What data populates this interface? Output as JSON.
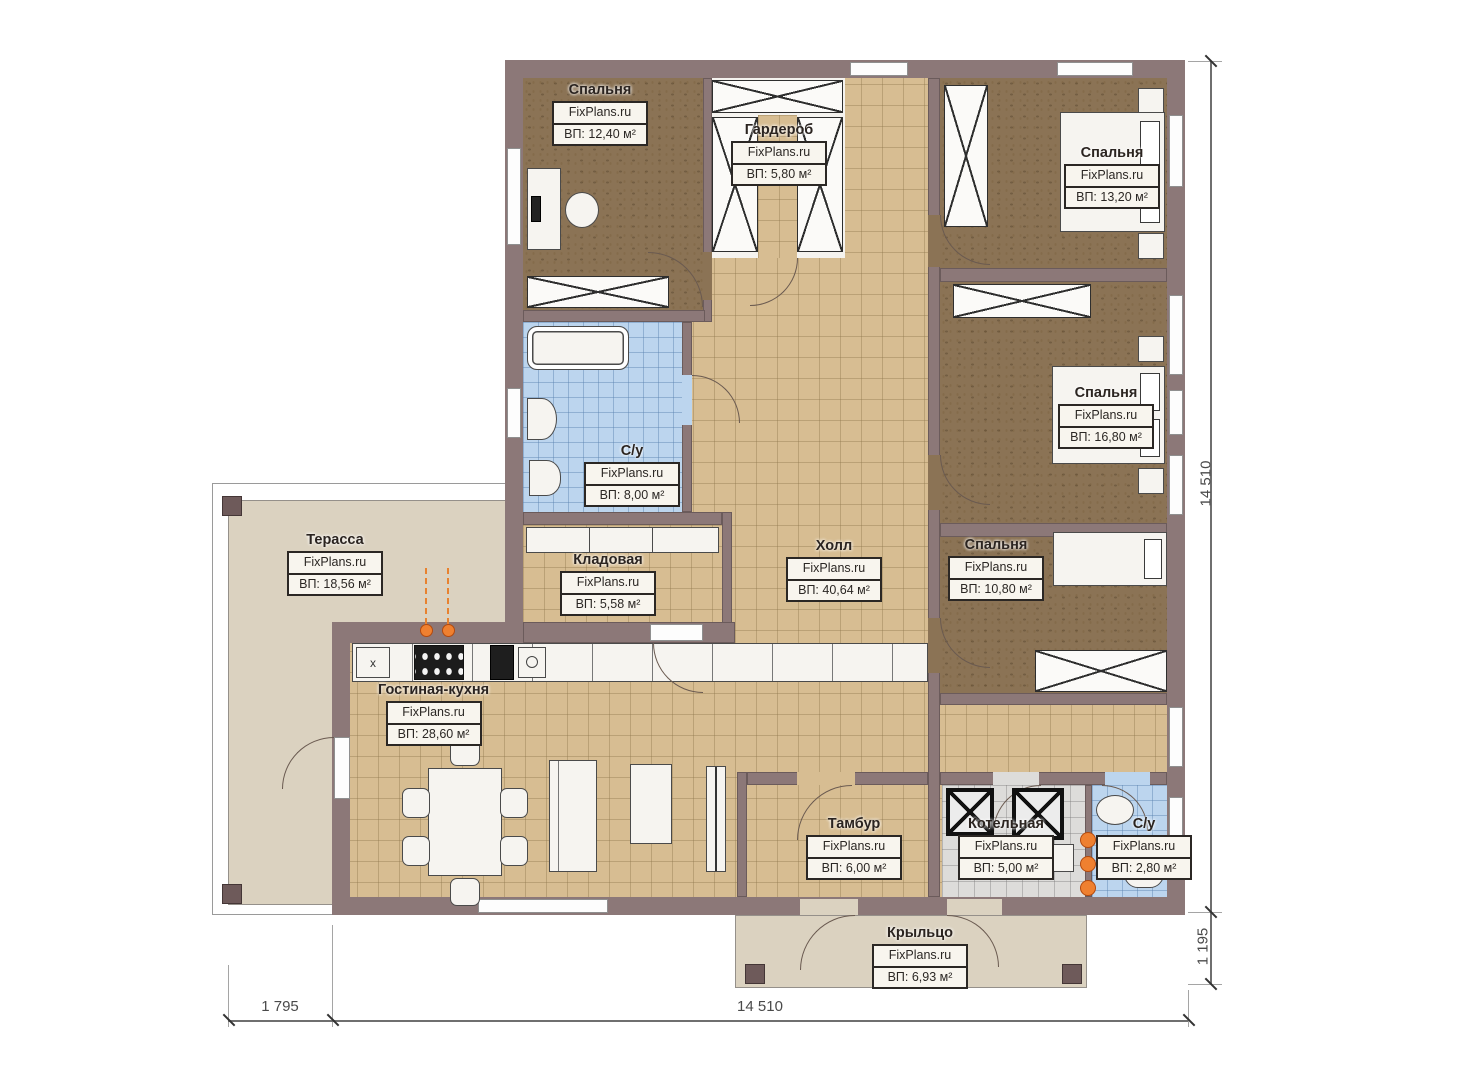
{
  "plan": {
    "watermark": "FixPlans.ru",
    "rooms": [
      {
        "key": "bedroom_tl",
        "name": "Спальня",
        "area": "ВП: 12,40 м²"
      },
      {
        "key": "wardrobe",
        "name": "Гардероб",
        "area": "ВП: 5,80 м²"
      },
      {
        "key": "bedroom_tr",
        "name": "Спальня",
        "area": "ВП: 13,20 м²"
      },
      {
        "key": "bathroom",
        "name": "С/у",
        "area": "ВП: 8,00 м²"
      },
      {
        "key": "bedroom_mr",
        "name": "Спальня",
        "area": "ВП: 16,80 м²"
      },
      {
        "key": "hall",
        "name": "Холл",
        "area": "ВП: 40,64 м²"
      },
      {
        "key": "storage",
        "name": "Кладовая",
        "area": "ВП: 5,58 м²"
      },
      {
        "key": "bedroom_br",
        "name": "Спальня",
        "area": "ВП: 10,80 м²"
      },
      {
        "key": "terrace",
        "name": "Терасса",
        "area": "ВП: 18,56 м²"
      },
      {
        "key": "living_kitchen",
        "name": "Гостиная-кухня",
        "area": "ВП: 28,60 м²"
      },
      {
        "key": "vestibule",
        "name": "Тамбур",
        "area": "ВП: 6,00 м²"
      },
      {
        "key": "boiler_room",
        "name": "Котельная",
        "area": "ВП: 5,00 м²"
      },
      {
        "key": "bathroom_small",
        "name": "С/у",
        "area": "ВП: 2,80 м²"
      },
      {
        "key": "porch",
        "name": "Крыльцо",
        "area": "ВП: 6,93 м²"
      }
    ],
    "dimensions": {
      "right_height": "14 510",
      "right_porch": "1 195",
      "bottom_terrace": "1 795",
      "bottom_width": "14 510"
    },
    "symbols": {
      "kitchen_unit": "x",
      "boiler_gauge": "○"
    },
    "colors": {
      "wall": "#8c7878",
      "floor_tile": "#d7bd92",
      "floor_bedroom": "#8b7355",
      "floor_bath": "#bcd5ee",
      "floor_boiler": "#dddcda",
      "terrace": "#dbd2c0",
      "accent_orange": "#ef8030"
    }
  }
}
